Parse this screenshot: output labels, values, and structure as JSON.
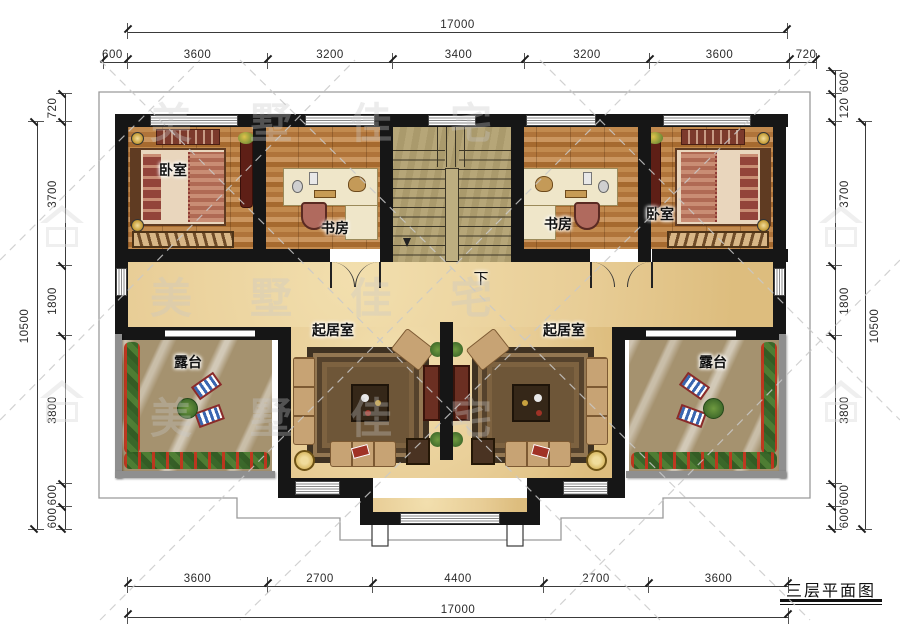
{
  "title_block": {
    "label": "三层平面图"
  },
  "rooms": {
    "bedroom_left": "卧室",
    "study_left": "书房",
    "study_right": "书房",
    "bedroom_right": "卧室",
    "living_left": "起居室",
    "living_right": "起居室",
    "terrace_left": "露台",
    "terrace_right": "露台",
    "stair_down": "下"
  },
  "dims": {
    "top": {
      "overall": "17000",
      "segments": [
        "600",
        "3600",
        "3200",
        "3400",
        "3200",
        "3600",
        "720"
      ]
    },
    "bottom": {
      "overall": "17000",
      "segments": [
        "3600",
        "2700",
        "4400",
        "2700",
        "3600"
      ]
    },
    "left": {
      "overall": "10500",
      "segments": [
        "720",
        "3700",
        "1800",
        "3800",
        "600",
        "600"
      ]
    },
    "right": {
      "overall": "10500",
      "segments": [
        "600",
        "120",
        "3700",
        "1800",
        "3800",
        "600",
        "600"
      ]
    }
  },
  "watermark": {
    "brand": "美墅佳宅"
  },
  "colors": {
    "wall": "#161616",
    "hall_floor": "#e8cd96",
    "wood_floor": "#b97e42",
    "stair_floor": "#b2a173",
    "terrace_floor": "#a5926f",
    "parapet": "#8f8f8f",
    "dimension_text": "#2b2b2b"
  }
}
